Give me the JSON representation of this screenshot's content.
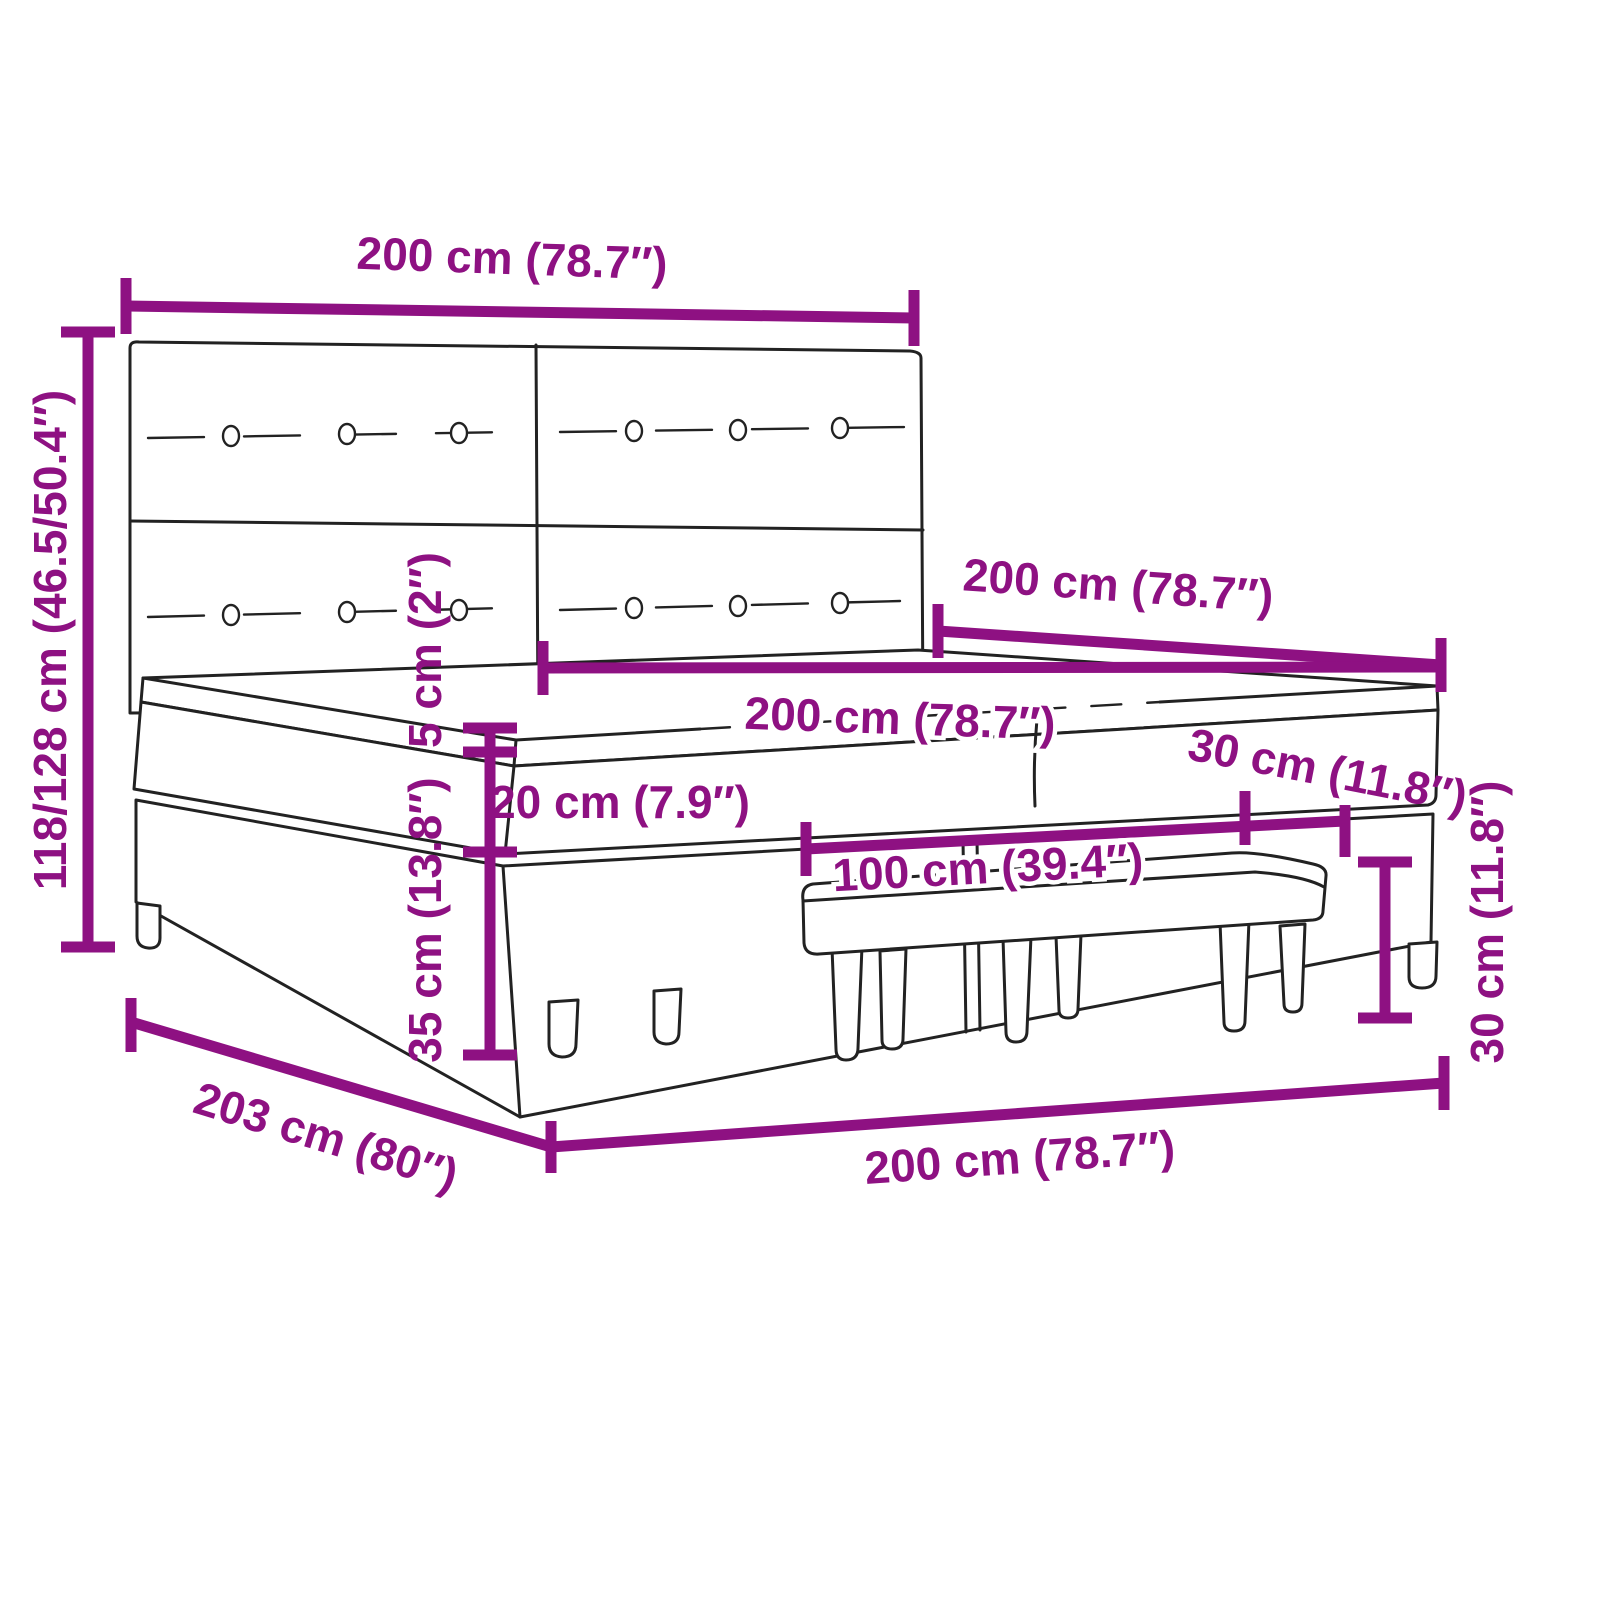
{
  "diagram": {
    "type": "product-dimension-diagram",
    "subject": "box spring bed with tufted headboard, mattress, topper and bench",
    "colors": {
      "dimension_accent": "#8E1182",
      "line_art": "#222222",
      "background": "#ffffff"
    },
    "dimensions": {
      "headboard_width": "200 cm (78.7″)",
      "total_height": "118/128 cm (46.5/50.4″)",
      "bed_length": "200 cm (78.7″)",
      "mattress_width": "200 cm (78.7″)",
      "topper_thickness": "5 cm (2″)",
      "mattress_thickness": "20 cm (7.9″)",
      "base_height": "35 cm (13.8″)",
      "bench_length": "100 cm (39.4″)",
      "bench_depth": "30 cm (11.8″)",
      "bench_height": "30 cm (11.8″)",
      "floor_length": "203 cm (80″)",
      "floor_width": "200 cm (78.7″)"
    }
  }
}
